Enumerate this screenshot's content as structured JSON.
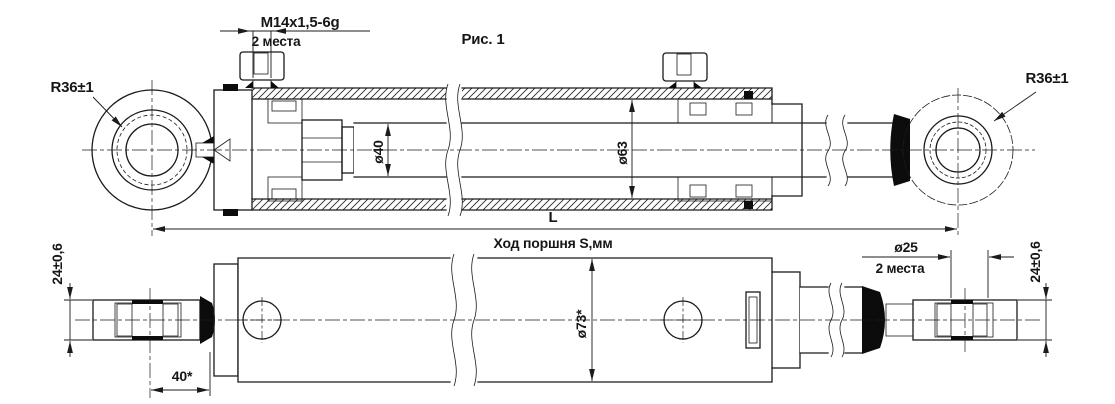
{
  "figure": {
    "caption": "Рис. 1"
  },
  "top_view": {
    "thread_callout": {
      "value": "M14x1,5-6g",
      "places_note": "2 места"
    },
    "left_eye_radius": "R36±1",
    "right_eye_radius": "R36±1",
    "rod_diameter": "ø40",
    "bore_diameter": "ø63",
    "length_label": "L",
    "stroke_label": "Ход поршня S,мм"
  },
  "bottom_view": {
    "left_eye_width": "24±0,6",
    "right_eye_width": "24±0,6",
    "pin_bore": {
      "value": "ø25",
      "places_note": "2 места"
    },
    "body_diameter": "ø73*",
    "eye_to_body_offset": "40*"
  },
  "colors": {
    "line": "#1b1b1b",
    "background": "#ffffff",
    "solid_fill": "#0c0c0c"
  }
}
